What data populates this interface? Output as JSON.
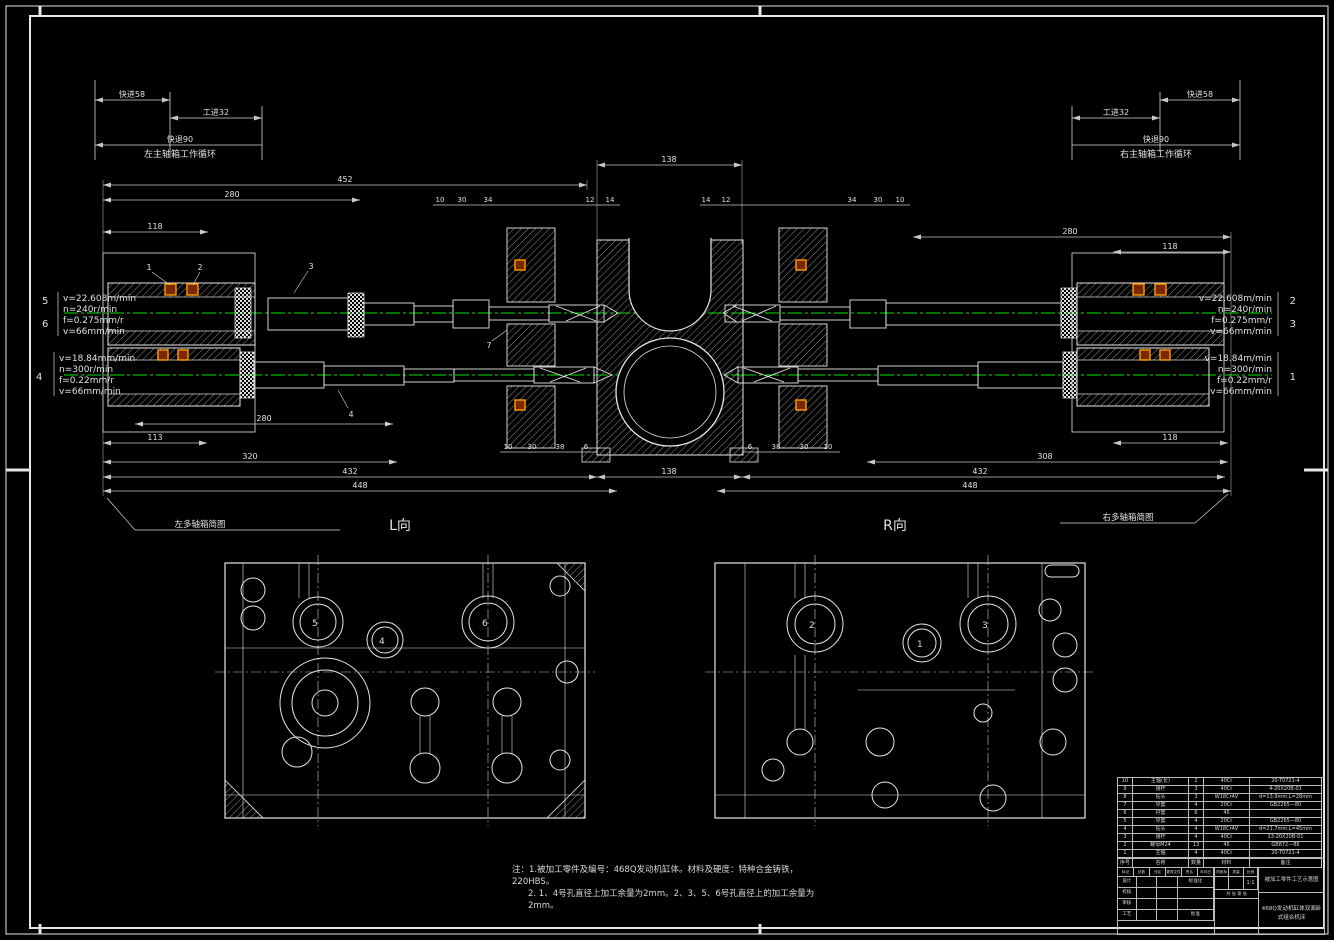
{
  "colors": {
    "background": "#000000",
    "line": "#e6e6e6",
    "dimension": "#c8c8c8",
    "centerline_green": "#00b400",
    "bearing_highlight_orange": "#ff9c00",
    "bearing_highlight_fill": "#7a2800"
  },
  "cycles": {
    "left": {
      "caption": "左主轴箱工作循环",
      "fast_forward": "快进58",
      "work_feed": "工进32",
      "fast_return": "快退90"
    },
    "right": {
      "caption": "右主轴箱工作循环",
      "fast_forward": "快进58",
      "work_feed": "工进32",
      "fast_return": "快退90"
    }
  },
  "spindle_params": {
    "left_upper": {
      "index_labels": [
        "5",
        "6"
      ],
      "lines": [
        "v=22.608m/min",
        "n=240r/min",
        "f=0.275mm/r",
        "v=66mm/min"
      ]
    },
    "left_lower": {
      "index_labels": [
        "4"
      ],
      "lines": [
        "v=18.84mm/min",
        "n=300r/min",
        "f=0.22mm/r",
        "v=66mm/min"
      ]
    },
    "right_upper": {
      "index_labels": [
        "2",
        "3"
      ],
      "lines": [
        "v=22.608m/min",
        "n=240r/min",
        "f=0.275mm/r",
        "v=66mm/min"
      ]
    },
    "right_lower": {
      "index_labels": [
        "1"
      ],
      "lines": [
        "v=18.84m/min",
        "n=300r/min",
        "f=0.22mm/r",
        "v=66mm/min"
      ]
    }
  },
  "dimensions": {
    "left_top": [
      "452",
      "280",
      "118"
    ],
    "top_center": "138",
    "bottom_center": "138",
    "left_bottom": [
      "280",
      "113",
      "320",
      "432",
      "448"
    ],
    "right_top": [
      "280",
      "118"
    ],
    "right_bottom": [
      "118",
      "308",
      "432",
      "448"
    ],
    "cluster_top_left": [
      "10",
      "30",
      "34",
      "12",
      "14"
    ],
    "cluster_top_right": [
      "14",
      "12",
      "34",
      "30",
      "10"
    ],
    "cluster_bottom_left": [
      "10",
      "30",
      "38",
      "6"
    ],
    "cluster_bottom_right": [
      "6",
      "38",
      "30",
      "10"
    ]
  },
  "part_leaders": [
    "1",
    "2",
    "3",
    "4",
    "7"
  ],
  "views": {
    "left": {
      "label": "L向",
      "leader": "左多轴箱简图",
      "holes": [
        "5",
        "4",
        "6"
      ]
    },
    "right": {
      "label": "R向",
      "leader": "右多轴箱简图",
      "holes": [
        "2",
        "1",
        "3"
      ]
    }
  },
  "notes": {
    "line1": "注：1.被加工零件及编号：468Q发动机缸体。材料及硬度：特种合金铸铁，220HBS。",
    "line2": "2. 1、4号孔直径上加工余量为2mm。2、3、5、6号孔直径上的加工余量为2mm。"
  },
  "title_block": {
    "headers": [
      "序号",
      "名称",
      "数量",
      "材料",
      "备注"
    ],
    "parts": [
      [
        "10",
        "主轴(长)",
        "2",
        "40Cr",
        "20-T0721-4"
      ],
      [
        "9",
        "接杆",
        "3",
        "40Cr",
        "4-20X20B-01"
      ],
      [
        "8",
        "钻头",
        "3",
        "W18Cr4V",
        "d=13.9mm,L=28mm"
      ],
      [
        "7",
        "导套",
        "4",
        "20Cr",
        "GB2265—80"
      ],
      [
        "6",
        "衬套",
        "6",
        "45",
        ""
      ],
      [
        "5",
        "导套",
        "4",
        "20Cr",
        "GB2265—80"
      ],
      [
        "4",
        "钻头",
        "4",
        "W18Cr4V",
        "d=21.7mm,L=45mm"
      ],
      [
        "3",
        "接杆",
        "4",
        "40Cr",
        "13-20X20B-01"
      ],
      [
        "2",
        "螺母M24",
        "13",
        "45",
        "GB872—86"
      ],
      [
        "1",
        "主轴",
        "4",
        "40Cr",
        "20-T0721-4"
      ]
    ],
    "mark_row": [
      "标记",
      "处数",
      "分区",
      "更改文件号",
      "签名",
      "年月日"
    ],
    "rows_left": [
      "设计",
      "校核",
      "审核",
      "工艺"
    ],
    "rows_mid": [
      "标准化",
      "批准"
    ],
    "stage_label": "阶段标记",
    "mass_label": "质量",
    "scale_label": "比例",
    "scale": "1:1",
    "sheet": "共 张  第 张",
    "title_line1": "被加工零件工艺示意图",
    "title_line2": "468Q发动机缸体双面卧式组合机床"
  }
}
